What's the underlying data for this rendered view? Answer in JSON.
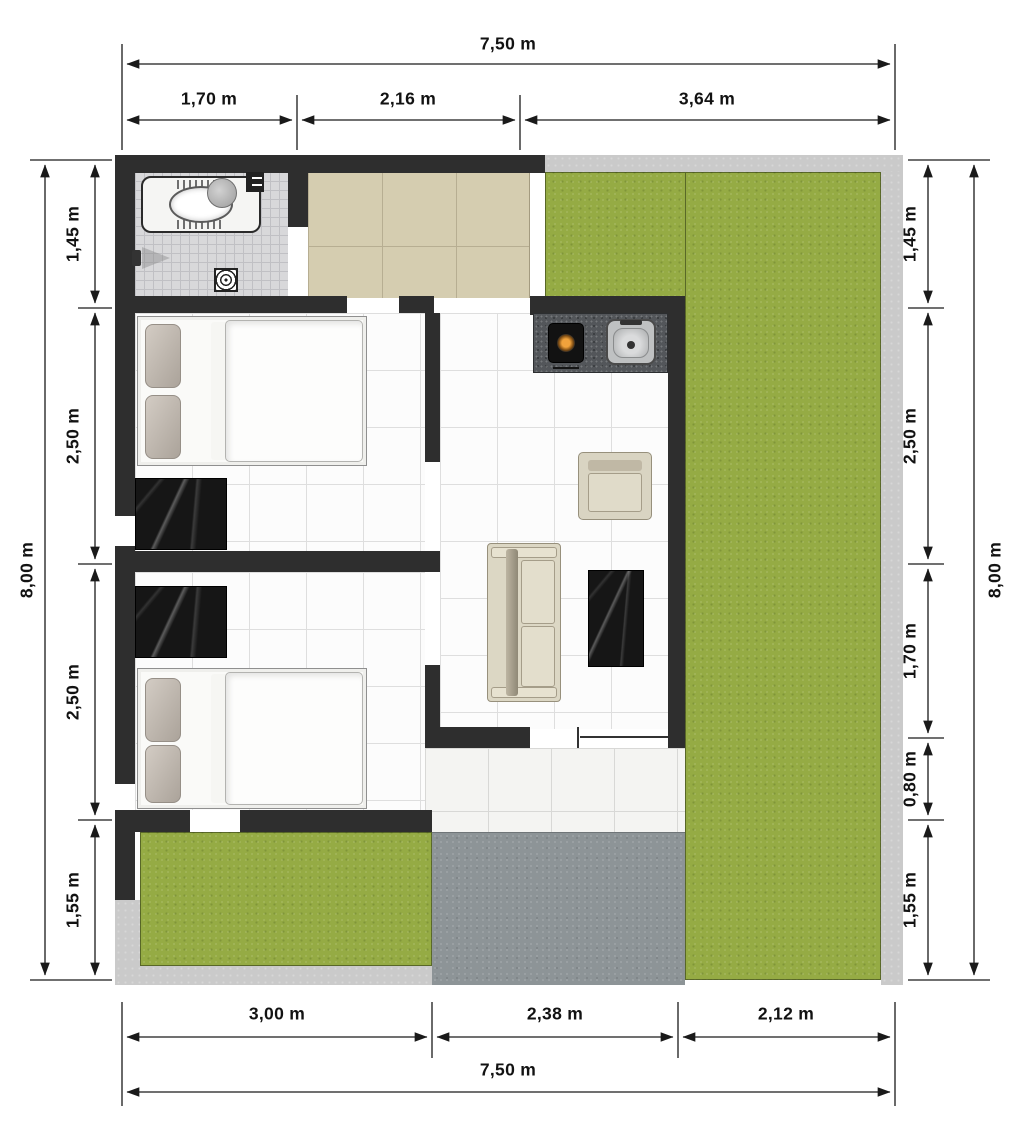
{
  "dimensions": {
    "top": {
      "total": "7,50 m",
      "segments": [
        "1,70 m",
        "2,16 m",
        "3,64 m"
      ]
    },
    "bottom": {
      "total": "7,50 m",
      "segments": [
        "3,00 m",
        "2,38 m",
        "2,12 m"
      ]
    },
    "left": {
      "total": "8,00 m",
      "segments": [
        "1,45 m",
        "2,50 m",
        "2,50 m",
        "1,55 m"
      ]
    },
    "right": {
      "total": "8,00 m",
      "segments": [
        "1,45 m",
        "2,50 m",
        "1,70 m",
        "0,80 m",
        "1,55 m"
      ]
    }
  },
  "colors": {
    "wall": "#2e2e2e",
    "grass": "#95ab44",
    "driveway": "#8d9497",
    "pavement": "#cacaca",
    "terrace_tile": "#d5cdb0",
    "bathroom_tile": "#d8d8da",
    "interior_tile": "#fcfcfc",
    "kitchen_counter": "#53565a",
    "marble_furniture": "#161616",
    "sofa_fabric": "#dcd7c4",
    "dimension_text": "#121212"
  }
}
